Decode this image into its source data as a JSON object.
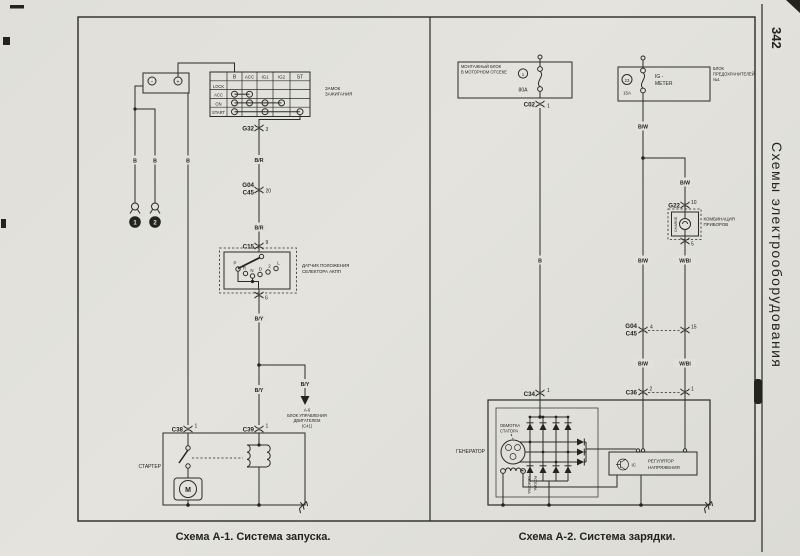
{
  "colors": {
    "paper": "#e3e2dc",
    "ink": "#24241f"
  },
  "sb": {
    "num": "342",
    "title": "Схемы электрооборудования"
  },
  "cap": {
    "a1": "Схема А-1. Система запуска.",
    "a2": "Схема А-2. Система зарядки."
  },
  "a1": {
    "bat": {
      "minus": "−",
      "plus": "+"
    },
    "b1": "B",
    "b2": "B",
    "b3": "B",
    "gnd1": "1",
    "gnd2": "2",
    "ign": {
      "l1": "ЗАМОК",
      "l2": "ЗАЖИГАНИЯ",
      "c": [
        "B",
        "ACC",
        "IG1",
        "IG2",
        "ST"
      ],
      "r": [
        "LOCK",
        "ACC",
        "ON",
        "START"
      ],
      "closed": {
        "ACC": [
          "B",
          "ACC"
        ],
        "ON": [
          "B",
          "ACC",
          "IG1",
          "IG2"
        ],
        "START": [
          "B",
          "IG1",
          "ST"
        ]
      }
    },
    "g32": "G32",
    "g32pin": "3",
    "br1": "B/R",
    "br2": "B/R",
    "g04": "G04",
    "c45": "C45",
    "g04pin": "20",
    "c15": "C15",
    "c15pin": "9",
    "c15out": "6",
    "sel": {
      "l1": "ДАТЧИК ПОЛОЖЕНИЯ",
      "l2": "СЕЛЕКТОРА АКПП",
      "pos": [
        "P",
        "R",
        "N",
        "D",
        "2",
        "L"
      ]
    },
    "by1": "B/Y",
    "by2": "B/Y",
    "by3": "B/Y",
    "ecu": [
      "A-6",
      "БЛОК УПРАВЛЕНИЯ",
      "ДВИГАТЕЛЕМ",
      "(C41)"
    ],
    "c38": "C38",
    "c38pin": "1",
    "c39": "C39",
    "c39pin": "1",
    "starter": "СТАРТЕР",
    "motor": "M"
  },
  "a2": {
    "efb": {
      "l1": "МОНТАЖНЫЙ БЛОК",
      "l2": "В МОТОРНОМ ОТСЕКЕ",
      "no": "1",
      "amp": "80A"
    },
    "c02": "C02",
    "c02pin": "1",
    "b": "B",
    "fb": {
      "no": "23",
      "amp": "15A",
      "cir1": "IG -",
      "cir2": "METER",
      "l1": "БЛОК",
      "l2": "ПРЕДОХРАНИТЕЛЕЙ",
      "l3": "№1"
    },
    "bw1": "B/W",
    "bw2": "B/W",
    "bw3": "B/W",
    "bw4": "B/W",
    "wbl1": "W/Bl",
    "wbl2": "W/Bl",
    "g22": "G22",
    "g22in": "10",
    "g22out": "5",
    "lamp": "CHARGE",
    "cl1": "КОМБИНАЦИЯ",
    "cl2": "ПРИБОРОВ",
    "g04": "G04",
    "c45": "C45",
    "p4": "4",
    "p15": "15",
    "c36": "C36",
    "p2": "2",
    "p1": "1",
    "c34": "C34",
    "c34pin": "1",
    "gen": "ГЕНЕРАТОР",
    "st1": "ОБМОТКА",
    "st2": "СТАТОРА",
    "rt1": "ОБМОТКА",
    "rt2": "РОТОРА",
    "ic": "IC",
    "reg1": "РЕГУЛЯТОР",
    "reg2": "НАПРЯЖЕНИЯ"
  }
}
